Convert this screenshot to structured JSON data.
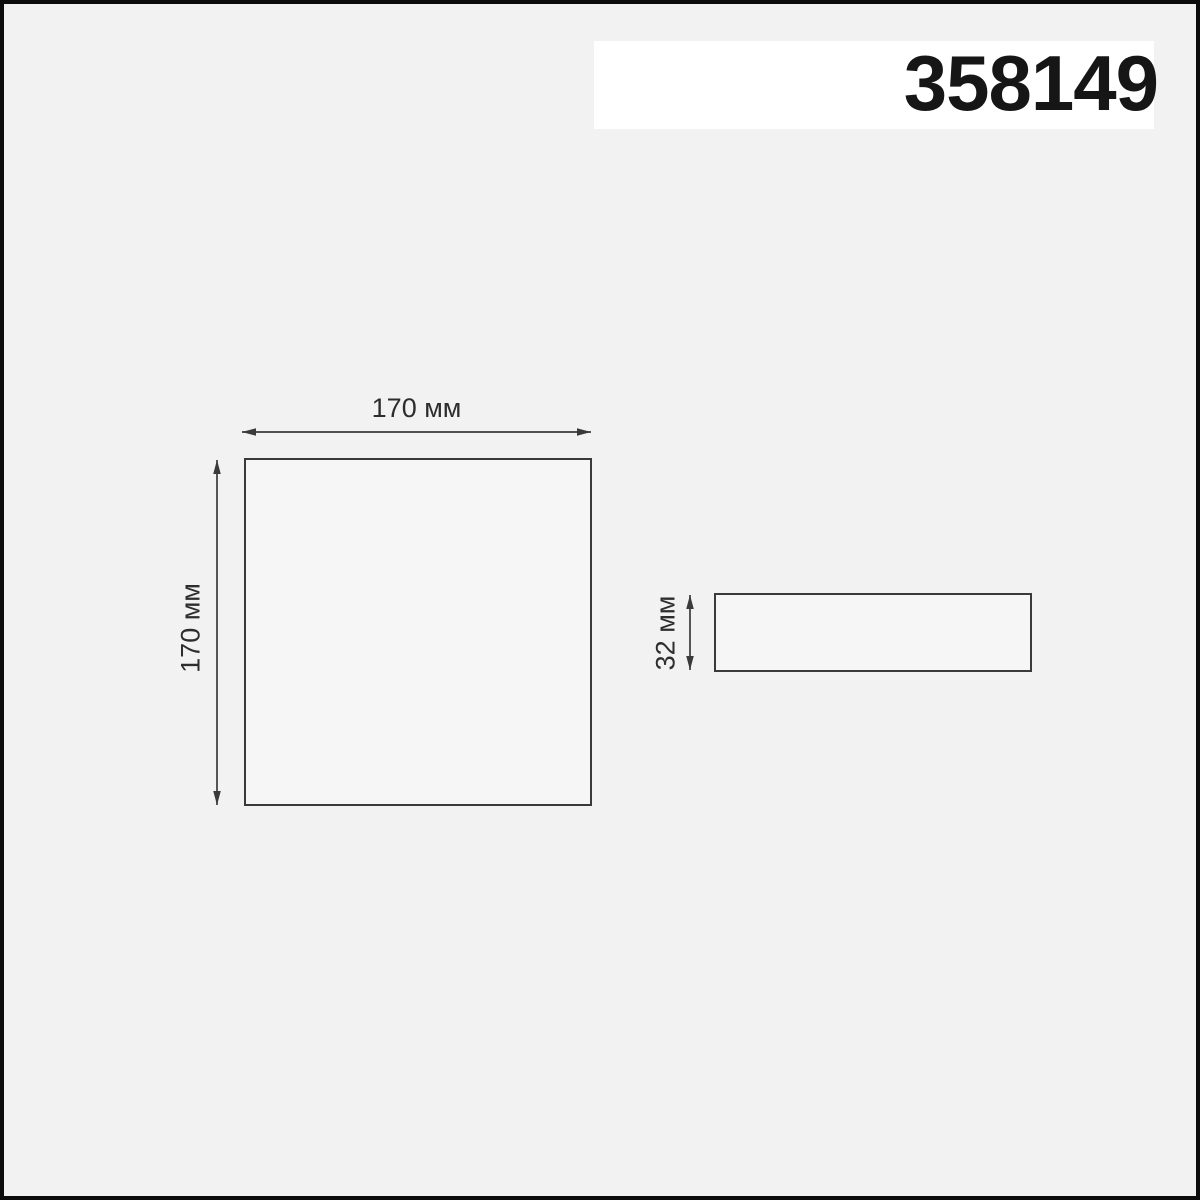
{
  "header": {
    "product_code": "358149"
  },
  "views": {
    "front": {
      "width_label": "170 мм",
      "height_label": "170 мм"
    },
    "side": {
      "height_label": "32 мм"
    }
  },
  "colors": {
    "background": "#f2f2f2",
    "frame_border": "#0c0c0c",
    "band_background": "#ffffff",
    "code_text": "#161616",
    "line": "#3a3a3a",
    "label_text": "#2d2d2d",
    "shape_fill": "#f6f6f6"
  }
}
